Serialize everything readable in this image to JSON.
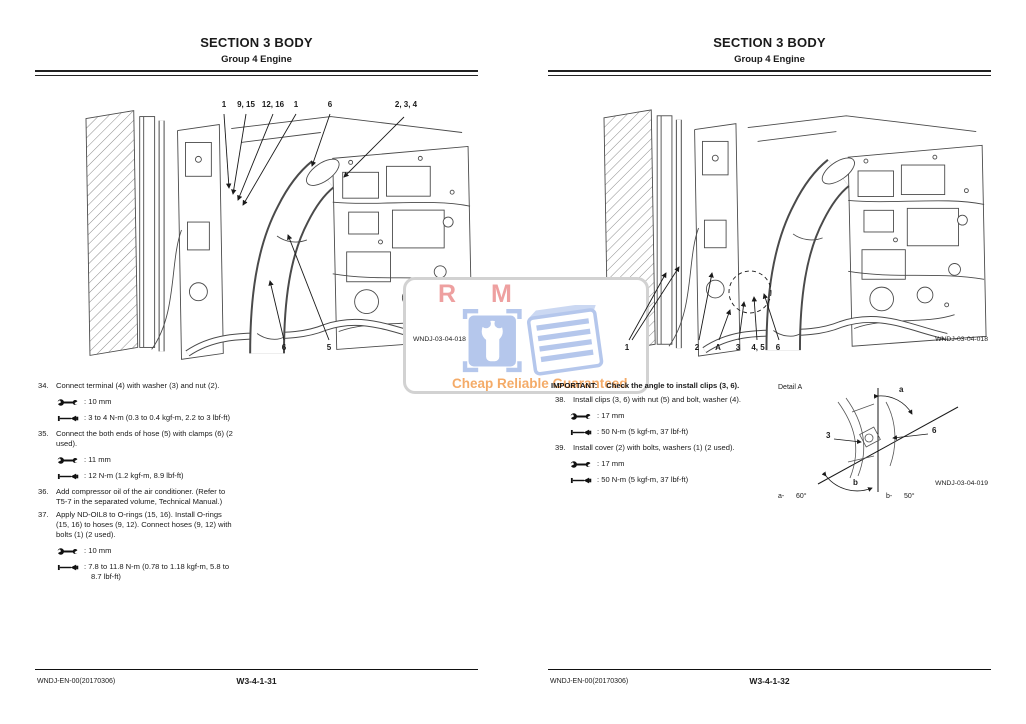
{
  "watermark": {
    "letters": "R M",
    "caption": "Cheap Reliable Guaranteed"
  },
  "left_page": {
    "header": {
      "title": "SECTION 3 BODY",
      "subtitle": "Group 4 Engine"
    },
    "figure_code": "WNDJ-03-04-018",
    "callouts_top": [
      "1",
      "9, 15",
      "12, 16",
      "1",
      "6",
      "2, 3, 4"
    ],
    "callouts_bottom": [
      "6",
      "5"
    ],
    "steps": [
      {
        "num": "34.",
        "lines": [
          "Connect terminal (4) with washer (3) and nut (2)."
        ],
        "specs": [
          {
            "icon": "wrench",
            "lines": [
              ": 10 mm"
            ]
          },
          {
            "icon": "torque",
            "lines": [
              ": 3 to 4 N-m (0.3 to 0.4 kgf-m, 2.2 to 3 lbf-ft)"
            ]
          }
        ]
      },
      {
        "num": "35.",
        "lines": [
          "Connect the both ends of hose (5) with clamps (6) (2",
          "used)."
        ],
        "specs": [
          {
            "icon": "wrench",
            "lines": [
              ": 11 mm"
            ]
          },
          {
            "icon": "torque",
            "lines": [
              ": 12 N-m (1.2 kgf-m, 8.9 lbf-ft)"
            ]
          }
        ]
      },
      {
        "num": "36.",
        "lines": [
          "Add compressor oil of the air conditioner. (Refer to",
          "T5-7 in the separated volume, Technical Manual.)"
        ],
        "specs": []
      },
      {
        "num": "37.",
        "lines": [
          "Apply ND-OIL8 to O-rings (15, 16). Install O-rings",
          "(15, 16) to hoses (9, 12). Connect hoses (9, 12) with",
          "bolts (1) (2 used)."
        ],
        "specs": [
          {
            "icon": "wrench",
            "lines": [
              ": 10 mm"
            ]
          },
          {
            "icon": "torque",
            "lines": [
              ": 7.8 to 11.8 N-m (0.78 to 1.18 kgf-m, 5.8 to",
              "8.7 lbf-ft)"
            ]
          }
        ]
      }
    ],
    "footer": {
      "doc_code": "WNDJ-EN-00(20170306)",
      "page_number": "W3-4-1-31"
    }
  },
  "right_page": {
    "header": {
      "title": "SECTION 3 BODY",
      "subtitle": "Group 4 Engine"
    },
    "figure_code": "WNDJ-03-04-018",
    "callouts_bottom": [
      "1",
      "2",
      "A",
      "3",
      "4, 5",
      "6"
    ],
    "important": {
      "label": "IMPORTANT:",
      "text": "Check the angle to install clips (3, 6)."
    },
    "steps": [
      {
        "num": "38.",
        "lines": [
          "Install clips (3, 6) with nut (5) and bolt, washer (4)."
        ],
        "specs": [
          {
            "icon": "wrench",
            "lines": [
              ": 17 mm"
            ]
          },
          {
            "icon": "torque",
            "lines": [
              ": 50 N-m (5 kgf-m, 37 lbf-ft)"
            ]
          }
        ]
      },
      {
        "num": "39.",
        "lines": [
          "Install cover (2) with bolts, washers (1) (2 used)."
        ],
        "specs": [
          {
            "icon": "wrench",
            "lines": [
              ": 17 mm"
            ]
          },
          {
            "icon": "torque",
            "lines": [
              ": 50 N-m (5 kgf-m, 37 lbf-ft)"
            ]
          }
        ]
      }
    ],
    "detail": {
      "label": "Detail A",
      "figure_code": "WNDJ-03-04-019",
      "callout_3": "3",
      "callout_6": "6",
      "angle_a_label": "a",
      "angle_b_label": "b",
      "angle_a_key": "a-",
      "angle_a_value": "60°",
      "angle_b_key": "b-",
      "angle_b_value": "50°"
    },
    "footer": {
      "doc_code": "WNDJ-EN-00(20170306)",
      "page_number": "W3-4-1-32"
    }
  }
}
